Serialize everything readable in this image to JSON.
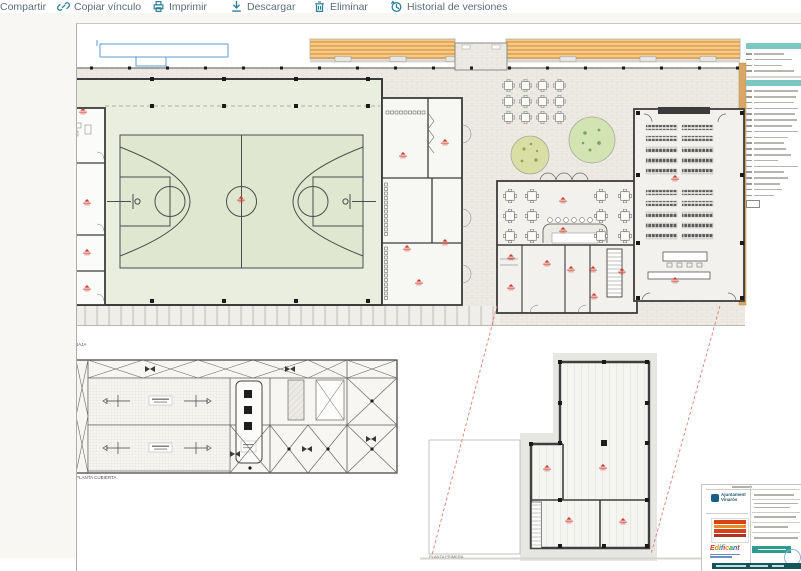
{
  "toolbar": {
    "items": [
      {
        "id": "share",
        "label": "Compartir",
        "icon": "share-icon"
      },
      {
        "id": "copy-link",
        "label": "Copiar vínculo",
        "icon": "link-icon"
      },
      {
        "id": "print",
        "label": "Imprimir",
        "icon": "printer-icon"
      },
      {
        "id": "download",
        "label": "Descargar",
        "icon": "download-icon"
      },
      {
        "id": "delete",
        "label": "Eliminar",
        "icon": "trash-icon"
      },
      {
        "id": "version-history",
        "label": "Historial de versiones",
        "icon": "history-icon"
      }
    ]
  },
  "drawing": {
    "floor_plan_label": "PLANTA BAJA",
    "roof_plan_label": "PLANTA CUBIERTA",
    "detail_plan_label": "PLANTA PRIMERA"
  },
  "title_block": {
    "municipality_line1": "Ajuntament",
    "municipality_line2": "Vinaròs",
    "program_name": "Edificant"
  },
  "colors": {
    "toolbar_icon": "#2e7f98",
    "toolbar_text": "#5d6e74",
    "court_green": "#dfe7d0",
    "hall_floor_green": "#e9eedf",
    "pergola_orange": "#e6a44e",
    "tree_green_1": "#d9dfa4",
    "tree_green_2": "#d2e4b2",
    "legend_header_teal": "#7cc7c3",
    "red_annotation": "#d0392e",
    "titleblock_teal": "#2f9b8e",
    "titleblock_bar": "#14555c",
    "existing_wall_tan": "#d9a868",
    "boundary_blue": "#5b9bd5"
  }
}
